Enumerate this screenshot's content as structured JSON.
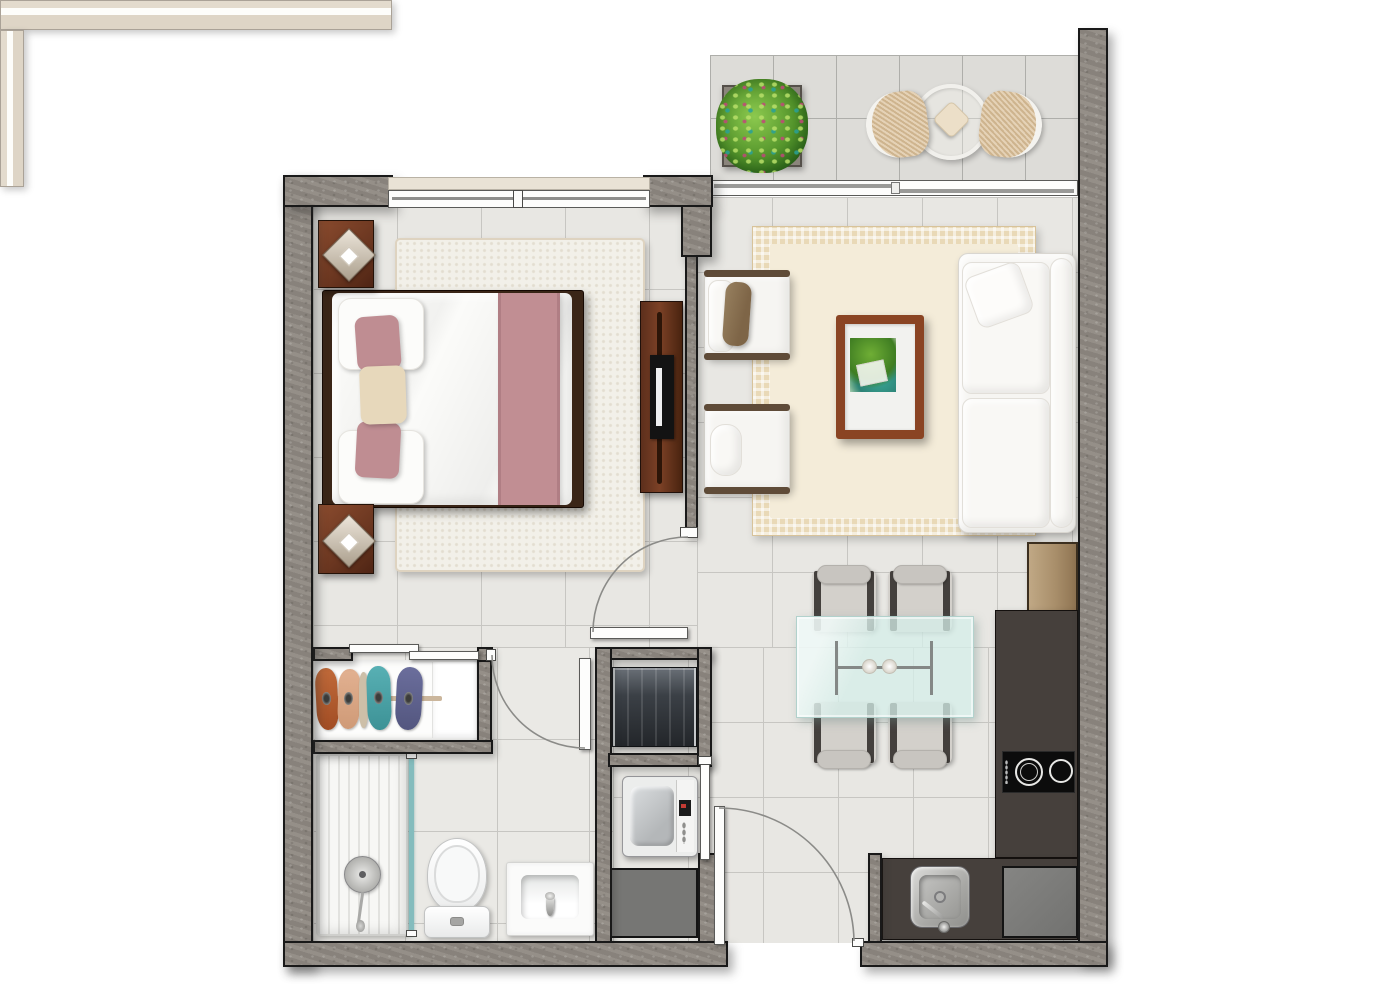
{
  "meta": {
    "title": "One-bedroom apartment floor plan (top-down rendered view)",
    "view": "top-down",
    "visible_text": "none"
  },
  "palette": {
    "page_background": "#ffffff",
    "wall_fill": "#8f8982",
    "wall_outline": "#191919",
    "tile_floor": "#e8e7e3",
    "tile_line": "#c7c6c2",
    "balcony_tile": "#dddcd8",
    "bedroom_rug": "#f2f0e9",
    "living_rug_border": "#e9d9b7",
    "living_rug_center": "#f4ecd9",
    "accent_mauve": "#c18e93",
    "pillow_beige": "#e7d8bb",
    "wood_dark": "#6a3620",
    "wood_light": "#b49a76",
    "counter_dark": "#46403c",
    "glass_table_teal": "#d5efe9",
    "shower_glass_teal": "#84bcbd",
    "appliance_gray": "#7c7c7a",
    "upholstery_white": "#f6f5f2",
    "wicker_tan": "#dcc39e",
    "plant_green": "#5ea832"
  },
  "rooms": {
    "balcony": {
      "name": "Balcony",
      "items": [
        "potted plant in square planter",
        "round bistro table with seat cushion",
        "wicker chair left",
        "wicker chair right",
        "perimeter railing",
        "sliding glass door to living room"
      ]
    },
    "bedroom": {
      "name": "Bedroom",
      "items": [
        "double bed with white duvet and mauve runner",
        "two mauve pillows and one beige pillow",
        "dark wood headboard",
        "nightstand with pyramid lamp (top)",
        "nightstand with pyramid lamp (bottom)",
        "white shag area rug",
        "TV console with television",
        "exterior window"
      ]
    },
    "living_room": {
      "name": "Living room",
      "items": [
        "white three-seat sofa with throw pillow",
        "armchair with brown pillow",
        "armchair with white roll cushion",
        "wood coffee table with plants",
        "fringed cream area rug",
        "small wood side cabinet"
      ]
    },
    "dining_area": {
      "name": "Dining area",
      "items": [
        "glass dining table",
        "four upholstered dining chairs"
      ]
    },
    "kitchen": {
      "name": "Kitchen",
      "items": [
        "L-shaped dark countertop",
        "two-burner cooktop",
        "stainless steel sink with faucet",
        "under-counter appliance",
        "upper wood cabinet"
      ]
    },
    "bathroom": {
      "name": "Bathroom",
      "items": [
        "walk-in shower with glass screen and round drain",
        "toilet",
        "washbasin with faucet",
        "hinged door"
      ]
    },
    "closet": {
      "name": "Wardrobe closet",
      "items": [
        "sliding double doors",
        "clothes rail with hanging garments (orange, tan, teal, navy)",
        "white shelf stack"
      ]
    },
    "laundry": {
      "name": "Utility closet",
      "items": [
        "water-heater cabinet",
        "top-load washing machine",
        "storage compartment",
        "hinged closet door"
      ]
    },
    "entry": {
      "name": "Entrance",
      "items": [
        "entry door with 90-degree swing arc"
      ]
    },
    "counts": {
      "dining_chairs": 4,
      "cooktop_burners": 2,
      "balcony_chairs": 2,
      "armchairs": 2,
      "nightstands": 2
    }
  }
}
